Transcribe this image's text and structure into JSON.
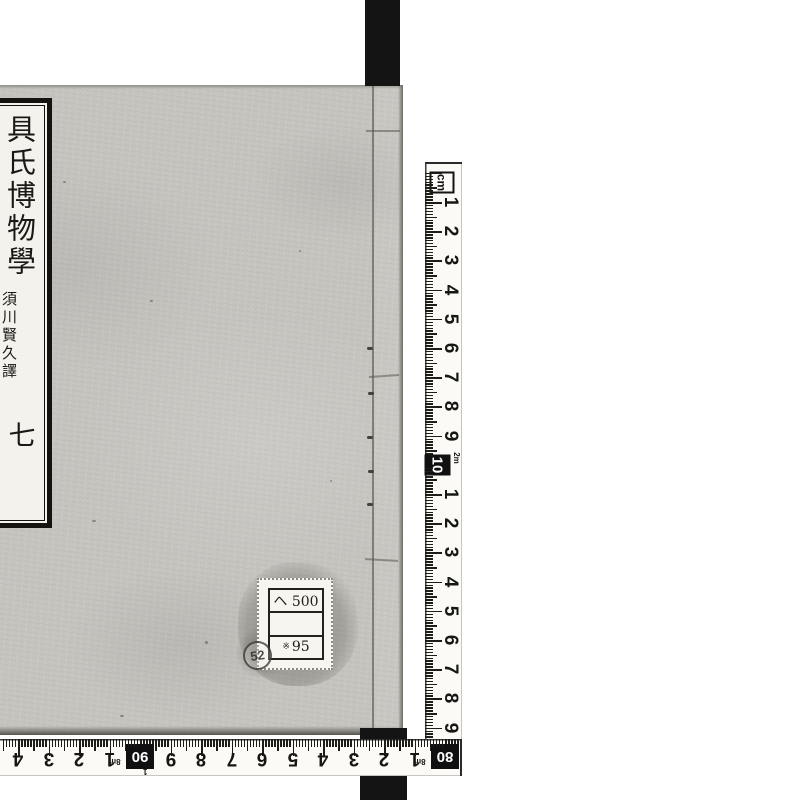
{
  "page": {
    "background": "#ffffff",
    "description_colors": {
      "cover": "#c6c5c0",
      "bars": "#141414",
      "label_paper": "#f3f2ec",
      "ruler_tape": "#fbfaf7"
    }
  },
  "book": {
    "title_label": {
      "title": "具氏博物學",
      "translator": "須川賢久譯",
      "volume": "七"
    },
    "sticker": {
      "row1": "ヘ 500",
      "row2": "",
      "row3_mark": "※",
      "row3": "95",
      "stamp": "52"
    }
  },
  "rulers": {
    "unit": "cm",
    "vertical": {
      "cm_labels": [
        "1",
        "2",
        "3",
        "4",
        "5",
        "6",
        "7",
        "8",
        "9"
      ],
      "decade_box": "10",
      "decade_note": "2m",
      "cm_labels_2": [
        "1",
        "2",
        "3",
        "4",
        "5",
        "6",
        "7",
        "8",
        "9"
      ]
    },
    "horizontal": {
      "segment_left": [
        "5",
        "4",
        "3",
        "2",
        "1"
      ],
      "box_90": "90",
      "box_90_note_a": "8m",
      "box_90_note_b": "1",
      "segment_mid": [
        "9",
        "8",
        "7",
        "6",
        "5",
        "4",
        "3",
        "2",
        "1"
      ],
      "box_80": "80",
      "box_80_note": "8m"
    }
  }
}
